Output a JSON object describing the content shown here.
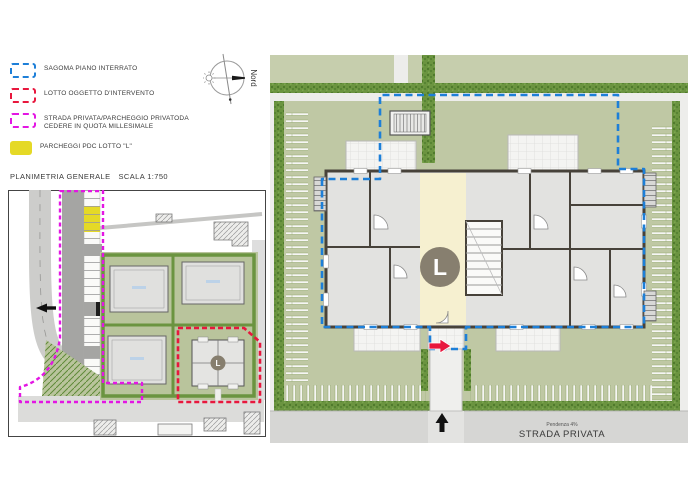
{
  "legend": {
    "items": [
      {
        "label": "SAGOMA PIANO INTERRATO",
        "swatch": "blue-dashed",
        "color": "#1d7fd8"
      },
      {
        "label": "LOTTO OGGETTO D'INTERVENTO",
        "swatch": "red-dashed",
        "color": "#e8173d"
      },
      {
        "label": "STRADA PRIVATA/PARCHEGGIO PRIVATODA CEDERE IN QUOTA MILLESIMALE",
        "swatch": "magenta-dashed",
        "color": "#e316e3"
      },
      {
        "label": "PARCHEGGI PDC LOTTO \"L\"",
        "swatch": "yellow-solid",
        "color": "#e5d926"
      }
    ]
  },
  "compass": {
    "label": "Nord"
  },
  "title": {
    "label": "PLANIMETRIA GENERALE",
    "scale": "SCALA 1:750"
  },
  "site_plan": {
    "lot_label": "L"
  },
  "detail_plan": {
    "lot_label": "L",
    "road_slope": "Pendenza 4%",
    "road_name": "STRADA PRIVATA"
  },
  "colors": {
    "basement_outline": "#1d7fd8",
    "lot_outline": "#e8173d",
    "private_road_outline": "#e316e3",
    "parking_fill": "#e5d926",
    "lawn": "#bfc8a4",
    "hedge": "#6b9440",
    "road": "#d6d6d4",
    "wall": "#47423a",
    "room": "#e2e2e0",
    "hall": "#f6f0d0",
    "stair_circle": "#877f6f"
  }
}
